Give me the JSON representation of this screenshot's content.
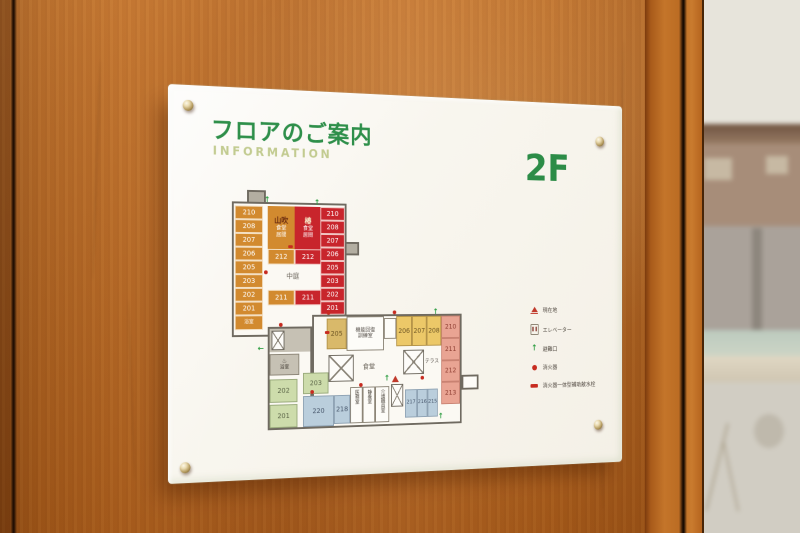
{
  "sign": {
    "title": "フロアのご案内",
    "subtitle": "INFORMATION",
    "floor_label": "2F"
  },
  "plan": {
    "upper_wing": {
      "left_rooms": [
        "210",
        "208",
        "207",
        "206",
        "205",
        "203",
        "202",
        "201"
      ],
      "left_bath": "浴室",
      "right_rooms": [
        "210",
        "208",
        "207",
        "206",
        "205",
        "203",
        "202",
        "201"
      ],
      "right_bath": "浴室",
      "orange_unit": {
        "name": "山吹",
        "line1": "食堂",
        "line2": "居間",
        "room_upper": "212",
        "room_lower": "211"
      },
      "red_unit": {
        "name": "椿",
        "line1": "食堂",
        "line2": "居間",
        "room_upper": "212",
        "room_lower": "211"
      },
      "courtyard": "中庭"
    },
    "lower_block": {
      "bath": "浴室",
      "room_205": "205",
      "rehab_line1": "機能回復",
      "rehab_line2": "訓練室",
      "yellow_rooms": [
        "206",
        "207",
        "208"
      ],
      "dining": "食堂",
      "terrace": "テラス",
      "green_203": "203",
      "green_202": "202",
      "green_201": "201",
      "blue_220": "220",
      "blue_218": "218",
      "staff_rooms": [
        "医務室",
        "静養室",
        "介護職員室"
      ],
      "blue_right": [
        "217",
        "216",
        "215"
      ],
      "pink_rooms": [
        "210",
        "211",
        "212",
        "213"
      ]
    }
  },
  "legend": {
    "items": [
      {
        "icon": "current-location-icon",
        "label": "現在地"
      },
      {
        "icon": "elevator-icon",
        "label": "エレベーター"
      },
      {
        "icon": "emergency-exit-icon",
        "label": "避難口"
      },
      {
        "icon": "fire-extinguisher-icon",
        "label": "消火器"
      },
      {
        "icon": "fire-hydrant-icon",
        "label": "消火器一体型補助散水栓"
      }
    ]
  },
  "icons": {
    "exit_arrow": "↑",
    "bath": "♨"
  },
  "colors": {
    "accent_green": "#2e8f4a",
    "subtitle_olive": "#c2cb90",
    "unit_orange": "#d28a2f",
    "unit_red": "#c8252c",
    "room_yellow": "#ecc868",
    "room_pink": "#e9a493",
    "room_green": "#cddcab",
    "room_blue": "#bacedc",
    "alert_red": "#c72b20",
    "wall_wood": "#b5641f"
  }
}
